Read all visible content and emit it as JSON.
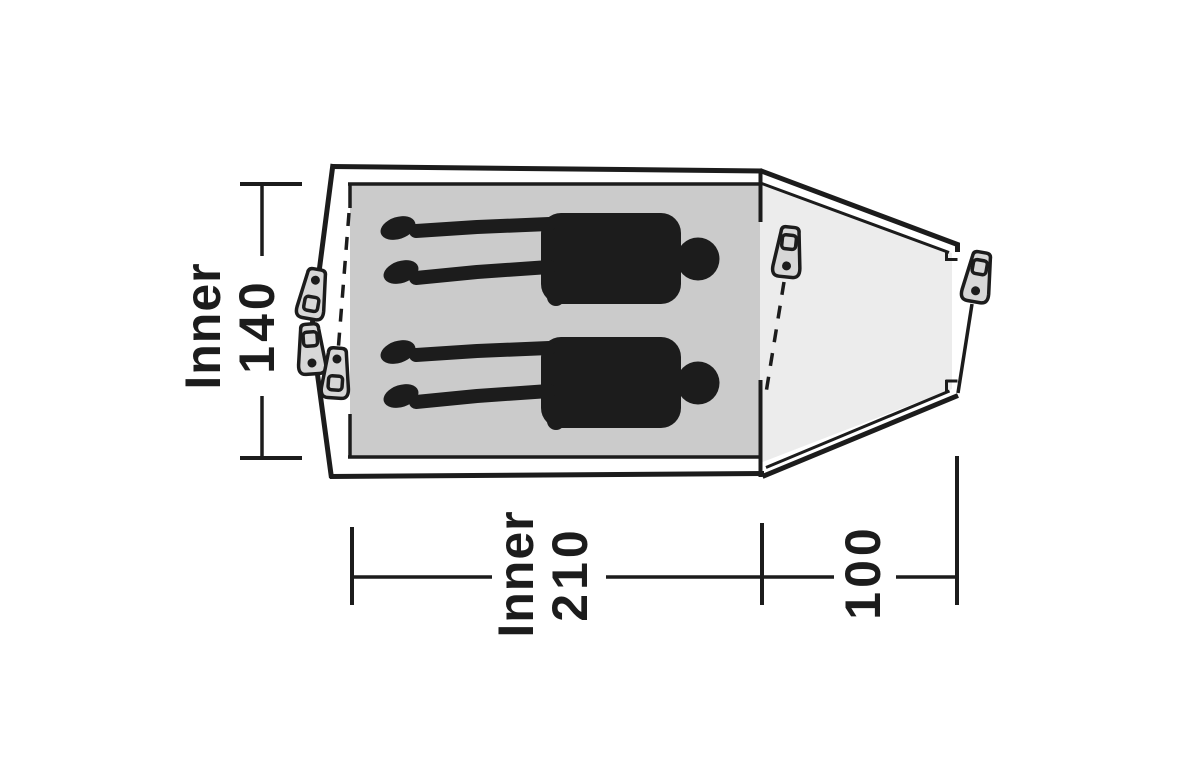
{
  "diagram": {
    "kind": "tent-floor-plan-top-view",
    "background": "#ffffff",
    "colors": {
      "line": "#1c1c1c",
      "inner_floor": "#cbcbcb",
      "porch": "#ececec",
      "peg_fill": "#d7d7d7",
      "silhouette": "#1c1c1c"
    },
    "dimensions": {
      "inner_width": {
        "word": "Inner",
        "value": "140"
      },
      "inner_length": {
        "word": "Inner",
        "value": "210"
      },
      "porch_depth": {
        "value": "100"
      }
    },
    "figures": {
      "person_count": 2,
      "peg_count": 5
    }
  }
}
